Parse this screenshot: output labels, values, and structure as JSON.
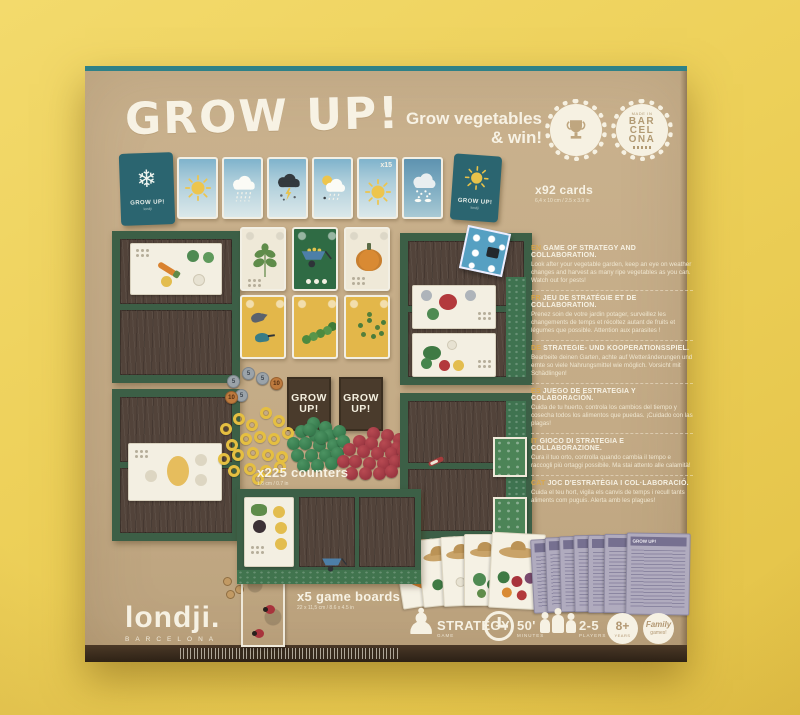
{
  "scene": {
    "background": "#edd059",
    "box_color": "#c3aa85",
    "teal_edge": "#2f8187",
    "text_cream": "#f6f1e3",
    "tag_gold": "#d8a74b"
  },
  "title": "GROW UP!",
  "tagline": {
    "line1": "Grow vegetables",
    "line2": "& win!"
  },
  "badges": {
    "made_in": "MADE IN",
    "barcelona_lines": [
      "BAR",
      "CEL",
      "ONA"
    ]
  },
  "weather_row": {
    "deck_label": "GROW UP!",
    "deck_sublabel": "londji",
    "multiplier_label": "x15",
    "count_label": "x92 cards",
    "count_dims": "6,4 x 10 cm / 2.5 x 3.9 in"
  },
  "counters": {
    "count_label": "x225 counters",
    "count_dims": "1,8 cm / 0.7 in",
    "coins": [
      "5",
      "5",
      "5",
      "10",
      "5",
      "10"
    ],
    "deck_box_label": "GROW UP!"
  },
  "boards_info": {
    "count_label": "x5 game boards",
    "count_dims": "22 x 11,5 cm / 8.6 x 4.5 in"
  },
  "languages": [
    {
      "tag": "EN",
      "heading": "GAME OF STRATEGY AND COLLABORATION.",
      "body": "Look after your vegetable garden, keep an eye on weather changes and harvest as many ripe vegetables as you can. Watch out for pests!"
    },
    {
      "tag": "FR",
      "heading": "JEU DE STRATÉGIE ET DE COLLABORATION.",
      "body": "Prenez soin de votre jardin potager, surveillez les changements de temps et récoltez autant de fruits et légumes que possible. Attention aux parasites !"
    },
    {
      "tag": "DE",
      "heading": "STRATEGIE- UND KOOPERATIONSSPIEL.",
      "body": "Bearbeite deinen Garten, achte auf Wetteränderungen und ernte so viele Nahrungsmittel wie möglich. Vorsicht mit Schädlingen!"
    },
    {
      "tag": "ES",
      "heading": "JUEGO DE ESTRATEGIA Y COLABORACIÓN.",
      "body": "Cuida de tu huerto, controla los cambios del tiempo y cosecha todos los alimentos que puedas. ¡Cuidado con las plagas!"
    },
    {
      "tag": "IT",
      "heading": "GIOCO DI STRATEGIA E COLLABORAZIONE.",
      "body": "Cura il tuo orto, controlla quando cambia il tempo e raccogli più ortaggi possibile. Ma stai attento alle calamità!"
    },
    {
      "tag": "CAT",
      "heading": "JOC D'ESTRATÈGIA I COL·LABORACIÓ.",
      "body": "Cuida el teu hort, vigila els canvis de temps i recull tants aliments com puguis. Alerta amb les plagues!"
    }
  ],
  "booklets": {
    "title": "GROW UP!"
  },
  "specs": {
    "type_label": "STRATEGY",
    "type_sub": "GAME",
    "time_label": "50'",
    "time_sub": "MINUTES",
    "players_label": "2-5",
    "players_sub": "PLAYERS",
    "age_label": "8+",
    "age_sub": "YEARS",
    "family_line1": "Family",
    "family_line2": "games!"
  },
  "brand": {
    "logo": "londji.",
    "city": "BARCELONA"
  },
  "icons": {
    "snowflake": "❄",
    "pawn": "♟"
  }
}
